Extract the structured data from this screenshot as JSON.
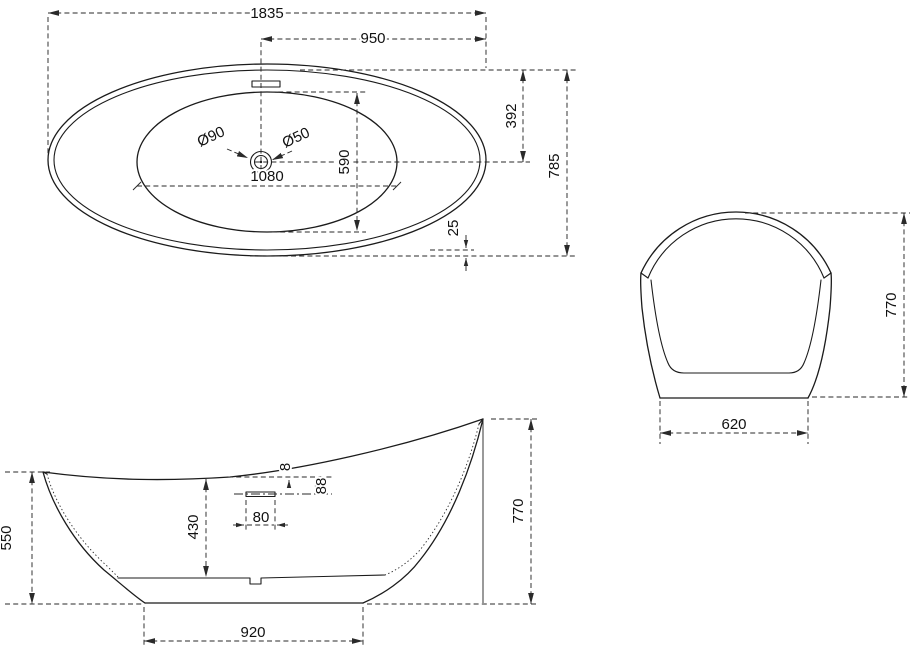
{
  "drawing_title": "freestanding-bathtub-dimension-drawing",
  "colors": {
    "line": "#1b1b1b",
    "dimension": "#2a2a2a",
    "background": "#ffffff"
  },
  "plan_view": {
    "overall_length": "1835",
    "drain_to_right_end": "950",
    "top_to_centerline": "392",
    "overall_width": "785",
    "rim_edge_gap": "25",
    "basin_length": "1080",
    "basin_width": "590",
    "drain_flange_diameter": "Ø90",
    "drain_diameter": "Ø50"
  },
  "side_view": {
    "front_rim_height": "550",
    "basin_depth": "430",
    "base_length": "920",
    "rear_rim_height": "770",
    "overflow_slot_width": "80",
    "overflow_below_rim": "88",
    "rim_edge_thickness": "8"
  },
  "end_view": {
    "overall_height": "770",
    "base_width": "620"
  }
}
